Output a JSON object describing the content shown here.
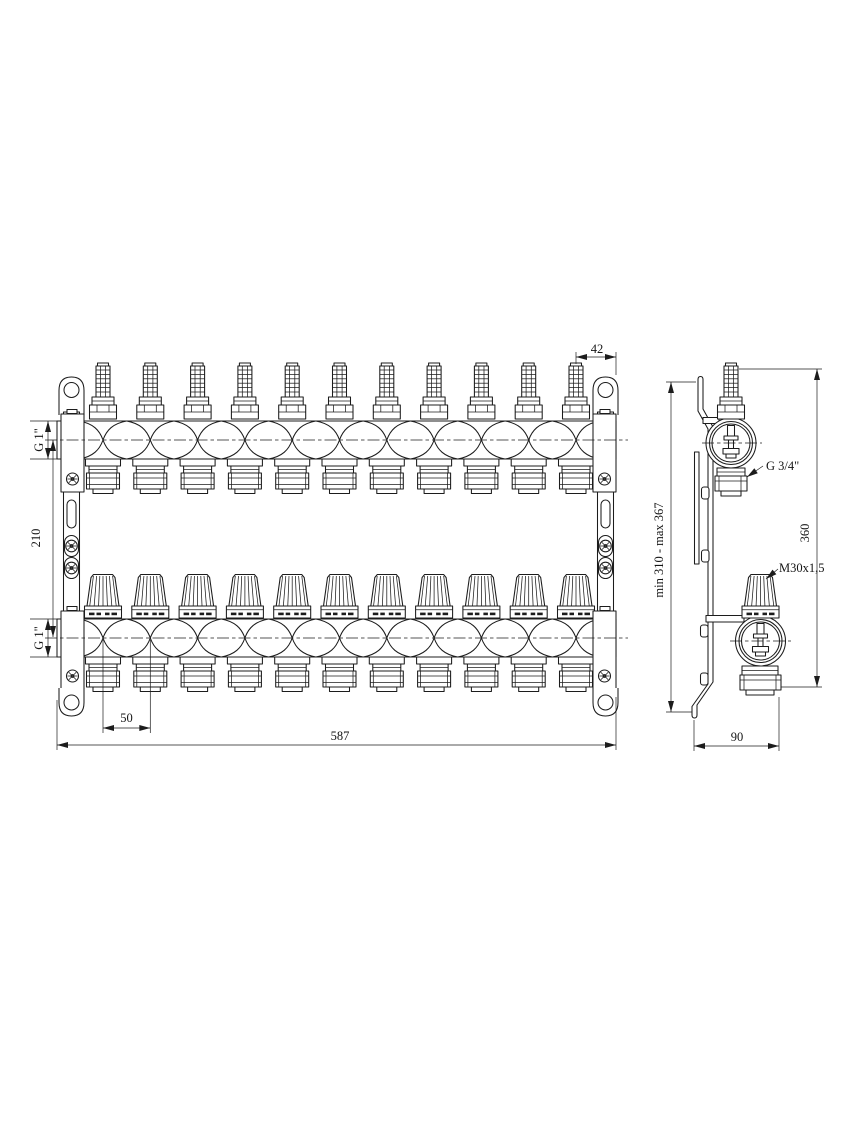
{
  "drawing": {
    "title": "manifold-technical-drawing",
    "line_color": "#1c1c1c",
    "outlet_count": 11,
    "front_view": {
      "dim_end_offset": "42",
      "dim_outlet_spacing": "50",
      "dim_total_width": "587",
      "dim_axis_distance": "210",
      "label_top_inlet": "G 1\"",
      "label_bottom_inlet": "G 1\""
    },
    "side_view": {
      "label_outlet_thread": "G 3/4\"",
      "label_valve_thread": "M30x1,5",
      "dim_bracket_height": "min 310 - max 367",
      "dim_overall_height": "360",
      "dim_bracket_depth": "90"
    }
  }
}
